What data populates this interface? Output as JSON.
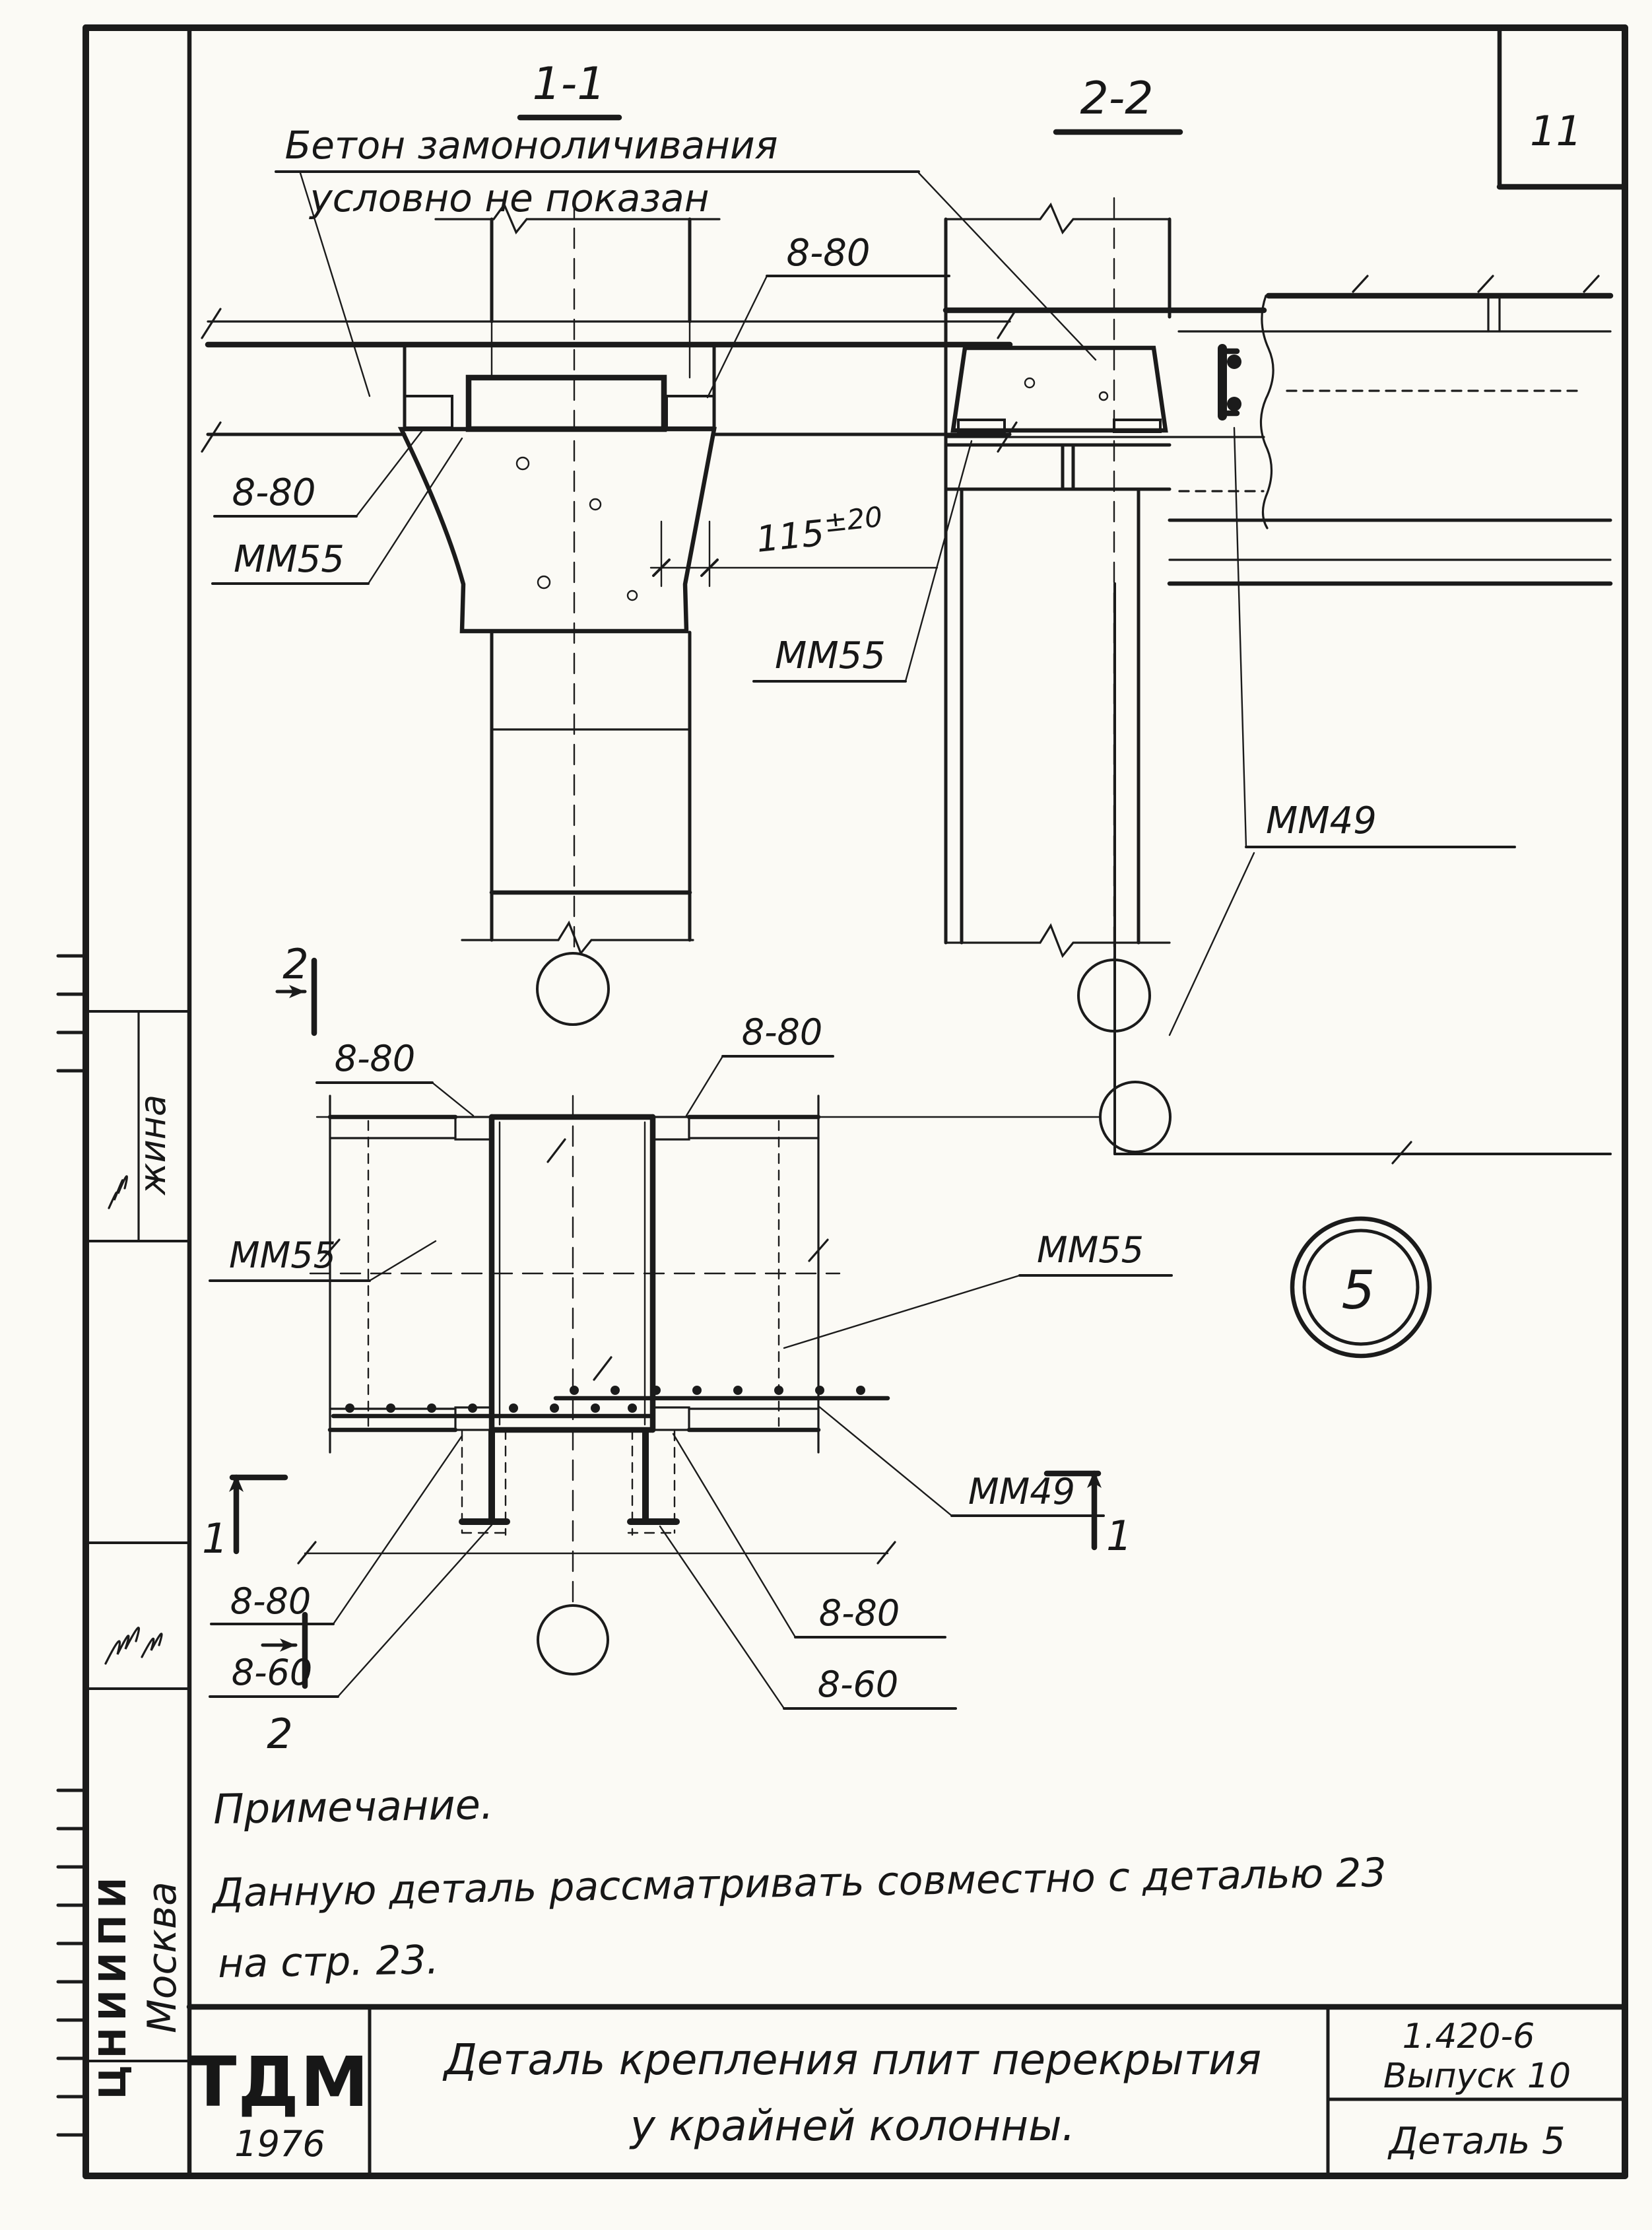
{
  "sheet": {
    "page_number": "11"
  },
  "sections": {
    "s1": {
      "title": "1-1"
    },
    "s2": {
      "title": "2-2"
    }
  },
  "top_note": {
    "line1": "Бетон замоноличивания",
    "line2": "условно не показан"
  },
  "labels": {
    "weld_8_80": "8-80",
    "weld_8_60": "8-60",
    "item_mm55": "ММ55",
    "item_mm49": "ММ49",
    "dim_value": "115",
    "dim_tol": "±20",
    "section_mark_1": "1",
    "section_mark_2": "2",
    "axis_badge": "5"
  },
  "note": {
    "heading": "Примечание.",
    "line1": "Данную деталь рассматривать совместно с деталью 23",
    "line2": "на стр. 23."
  },
  "title_block": {
    "logo": "ТДМ",
    "logo_year": "1976",
    "title_line1": "Деталь крепления плит перекрытия",
    "title_line2": "у крайней колонны.",
    "series": "1.420-6",
    "issue": "Выпуск 10",
    "detail": "Деталь 5"
  },
  "sidebar": {
    "org_stamp": "ЦНИИПИ",
    "city": "Москва",
    "signature": "жина"
  }
}
